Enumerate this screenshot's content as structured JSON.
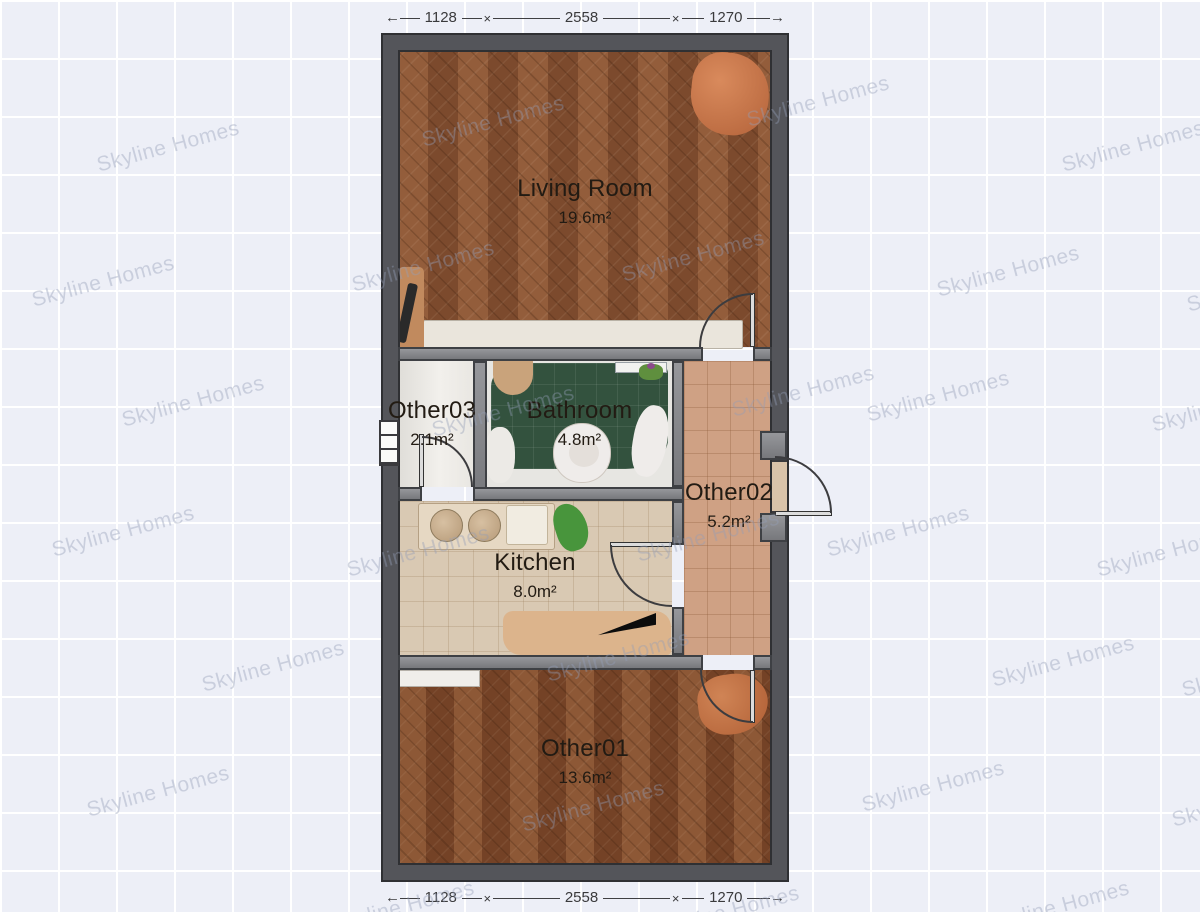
{
  "watermark": {
    "text": "Skyline Homes"
  },
  "dimensions": {
    "arrow_left": "←",
    "arrow_right": "→",
    "separator": "×",
    "top": {
      "left": "1128",
      "middle": "2558",
      "right": "1270"
    },
    "bottom": {
      "left": "1128",
      "middle": "2558",
      "right": "1270"
    }
  },
  "rooms": {
    "living_room": {
      "name": "Living Room",
      "area": "19.6m²"
    },
    "other03": {
      "name": "Other03",
      "area": "2.1m²"
    },
    "bathroom": {
      "name": "Bathroom",
      "area": "4.8m²"
    },
    "other02": {
      "name": "Other02",
      "area": "5.2m²"
    },
    "kitchen": {
      "name": "Kitchen",
      "area": "8.0m²"
    },
    "other01": {
      "name": "Other01",
      "area": "13.6m²"
    }
  },
  "colors": {
    "background": "#edeff7",
    "grid_line": "#ffffff",
    "outer_wall": "#54555a",
    "inner_wall": "#86878b",
    "wall_outline": "#3e4044",
    "wood_floor": "#8a5536",
    "bathroom_tile": "#33523e",
    "kitchen_floor": "#d9c9b3",
    "hall_tile": "#cfa184",
    "other03_floor": "#eceae6",
    "label_text": "#221b13",
    "dimension_text": "#3a3a3c",
    "watermark_text": "#949eb6"
  }
}
